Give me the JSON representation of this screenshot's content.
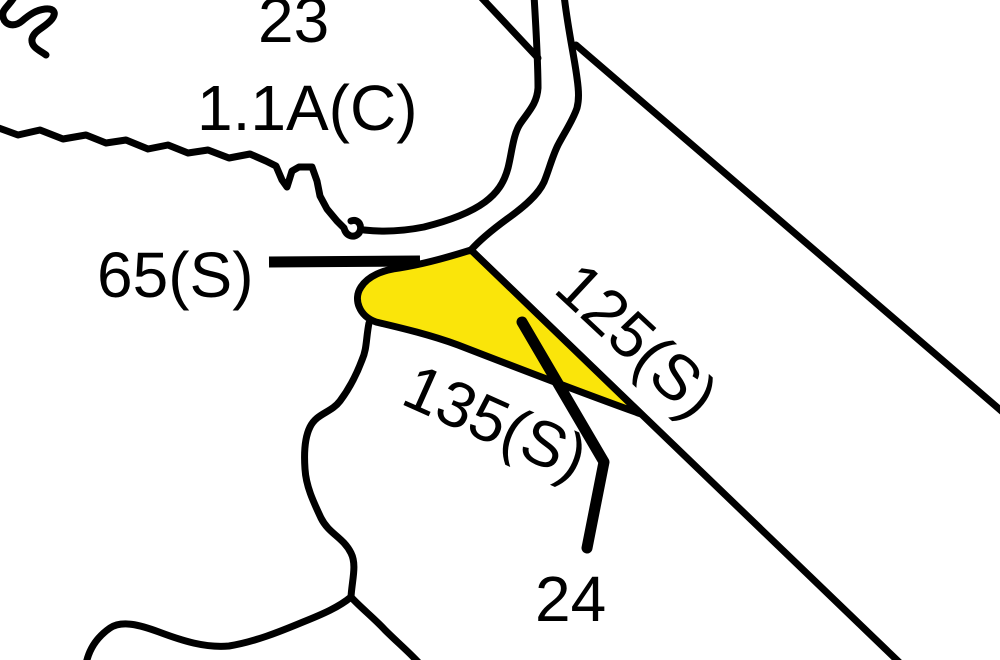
{
  "map": {
    "type": "cadastral-parcel-map",
    "colors": {
      "background": "#ffffff",
      "lines": "#000000",
      "highlight": "#fae50a"
    },
    "labels": {
      "parcel_23": "23",
      "parcel_23_area": "1.1A(C)",
      "lot_65": "65(S)",
      "lot_125": "125(S)",
      "lot_135": "135(S)",
      "parcel_24": "24"
    }
  }
}
